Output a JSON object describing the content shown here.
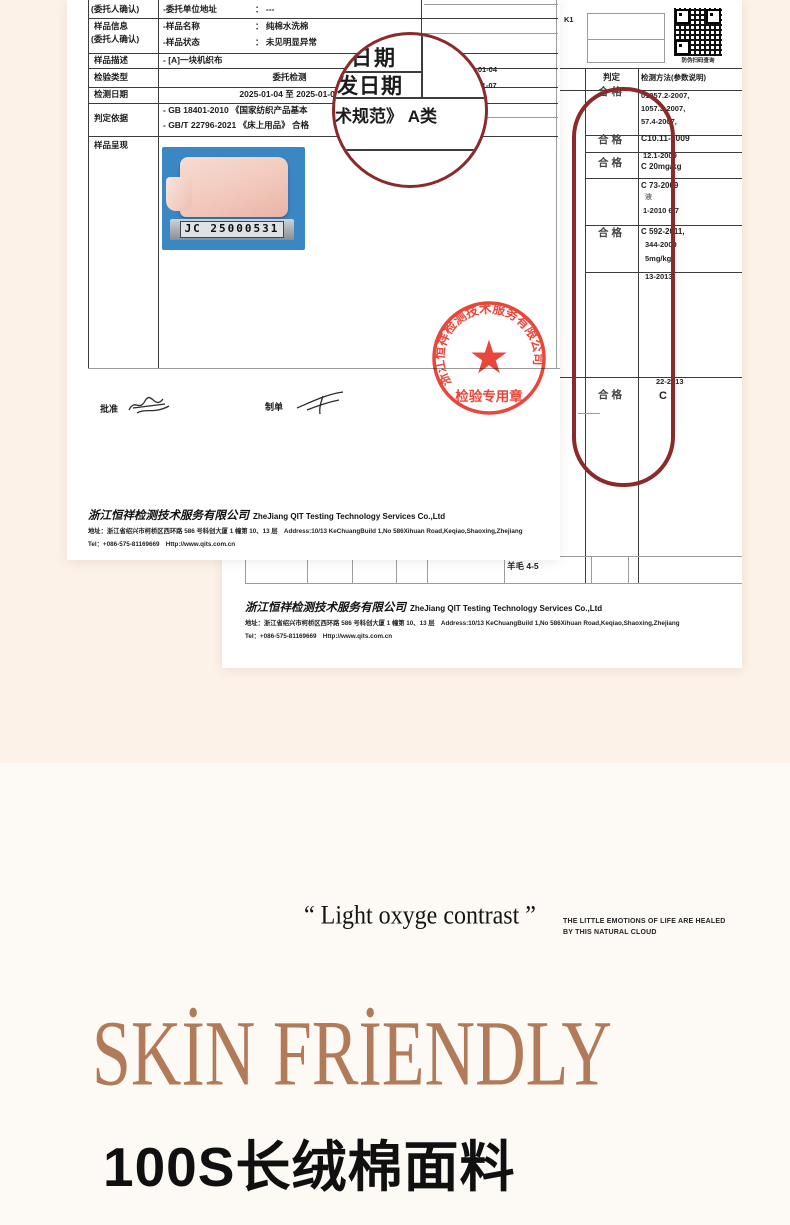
{
  "palette": {
    "page_cream": "#fdf2e8",
    "page_light": "#fdfaf6",
    "accent_brown": "#b17a59",
    "stamp_red": "#e8392c",
    "magnifier_maroon": "#8b2a2a",
    "photo_blue": "#3b87c4"
  },
  "report1": {
    "rows": {
      "r1": {
        "label": "(委托人确认)",
        "field": "-委托单位地址",
        "value": "： ---"
      },
      "r2": {
        "label1": "样品信息",
        "label2": "(委托人确认)",
        "field1": "-样品名称",
        "value1": "： 纯棉水洗棉",
        "field2": "-样品状态",
        "value2": "： 未见明显异常"
      },
      "r3": {
        "label": "样品描述",
        "value": "- [A]一块机织布"
      },
      "r4": {
        "label": "检验类型",
        "value": "委托检测"
      },
      "r5": {
        "label": "检测日期",
        "value": "2025-01-04 至 2025-01-07"
      },
      "r6": {
        "label": "判定依据",
        "line1": "- GB 18401-2010 《国家纺织产品基本",
        "line2": "- GB/T 22796-2021 《床上用品》 合格"
      },
      "r7": {
        "label": "样品呈现"
      }
    },
    "dates": {
      "d1": "25-01-04",
      "d2": "-01-07"
    },
    "magnifier": {
      "t1": "日期",
      "t2": "发日期",
      "t3": "术规范》 A类"
    },
    "photo_tag": "JC 25000531",
    "sign": {
      "approve": "批准",
      "prepare": "制单"
    }
  },
  "report2": {
    "serial": "K1",
    "qr_caption": "防伪扫码查询",
    "table": {
      "header_verdict": "判定",
      "header_method": "检测方法(参数说明)",
      "verdicts": [
        "合格",
        "合格",
        "合格",
        "合格",
        "合格"
      ],
      "methods": [
        "01057.2-2007,",
        "1057.3-2007,",
        "57.4-2007,",
        "C10.11-2009",
        "12.1-2009",
        "C 20mg/kg",
        "C 73-2009",
        "液",
        "1-2010 6.7",
        "C 592-2011,",
        "344-2009",
        "5mg/kg",
        "13-2013",
        "22-2013",
        "C"
      ],
      "bottom_cell": "羊毛  4-5"
    }
  },
  "footer": {
    "company_cn": "浙江恒祥检测技术服务有限公司",
    "company_en": "ZheJiang QIT Testing Technology Services Co.,Ltd",
    "address": "地址：浙江省绍兴市柯桥区西环路 586 号科创大厦 1 幢第 10、13 层　Address:10/13 KeChuangBuild 1,No 586Xihuan Road,Keqiao,Shaoxing,Zhejiang",
    "tel": "Tel：+086-575-81169669　Http://www.qits.com.cn"
  },
  "stamp": {
    "ring": "浙江恒祥检测技术服务有限公司",
    "label": "检验专用章",
    "star": "★"
  },
  "hero": {
    "quote": "“ Light oxyge contrast ”",
    "tagline1": "THE LITTLE EMOTIONS OF LIFE ARE HEALED",
    "tagline2": "BY THIS NATURAL CLOUD",
    "title": "SKİN FRİENDLY",
    "subtitle": "100S长绒棉面料"
  }
}
